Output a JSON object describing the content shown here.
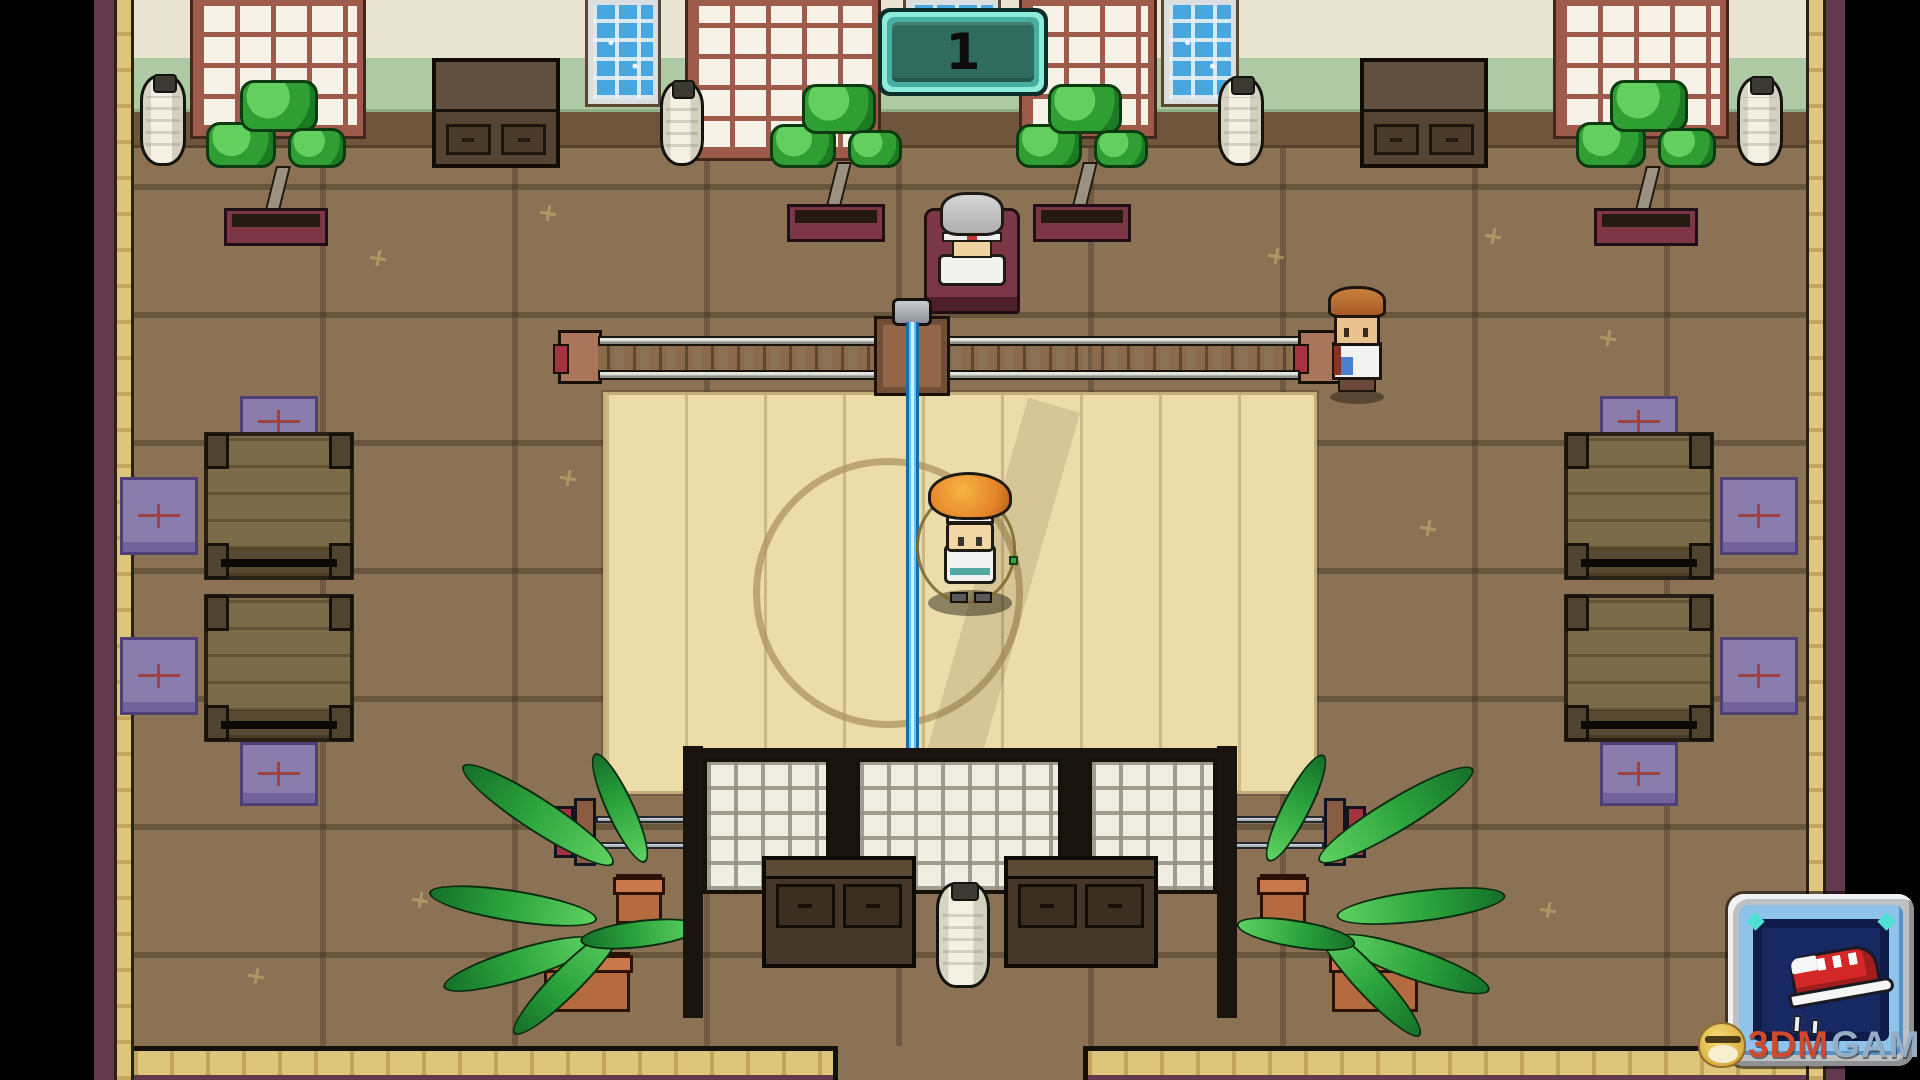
{
  "scene": {
    "description": "pixel-art dojo interior, top-down view",
    "sign": {
      "label": "1"
    }
  },
  "hud": {
    "run_button": {
      "icon": "running-shoe-icon",
      "motion_lines": "double-dash"
    }
  },
  "watermark": {
    "part1": "3DM",
    "part2": "GAME",
    "mascot": "chick-mascot-icon"
  },
  "entities": {
    "player": "player character skipping with jump rope on training mat",
    "coach": "grey-haired coach seated on red chair at top",
    "npc": "standing npc in white shirt at right end of rail"
  },
  "colors": {
    "sign_teal": "#2f6b5f",
    "sign_border": "#8debd9",
    "rope_blue": "#5ec4f2",
    "button_navy": "#182862",
    "button_frame_blue": "#8fc3ea",
    "shoe_red": "#d42727",
    "floor_brown": "#8b7254",
    "mat_tan": "#ecdcaa",
    "wall_green": "#aec9a4",
    "cushion_purple": "#8a7cab",
    "wood_maroon": "#62394f",
    "watermark_red": "#cf4a2e",
    "watermark_blue": "#93aec6"
  }
}
